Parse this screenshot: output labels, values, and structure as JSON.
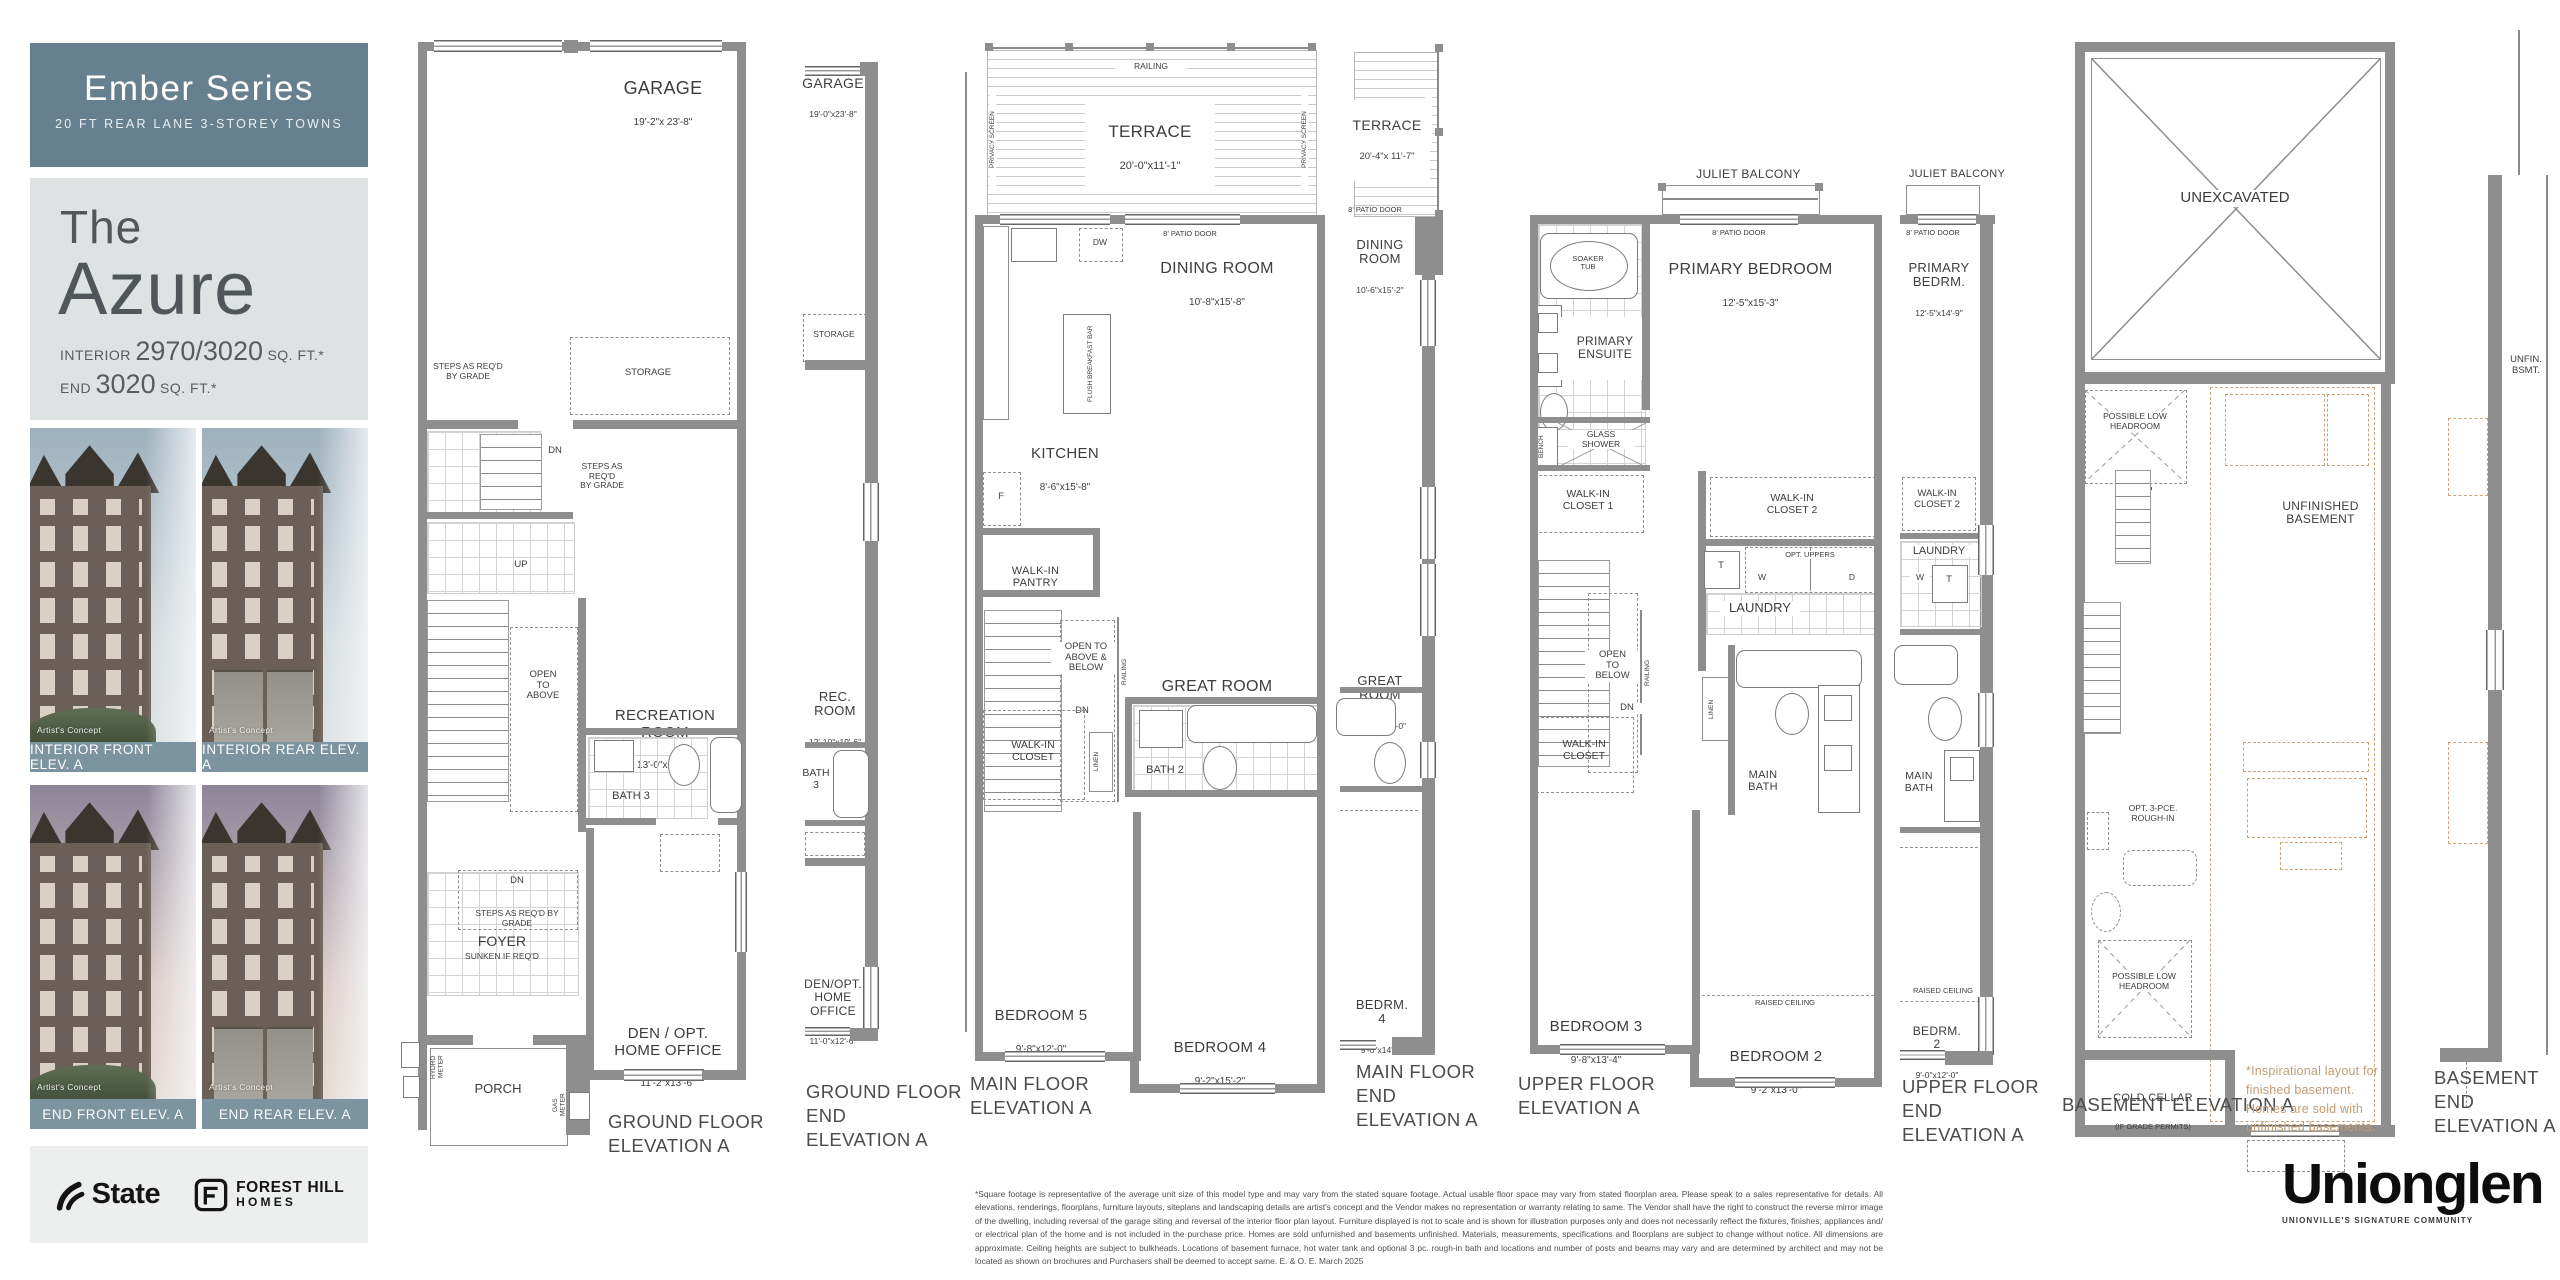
{
  "sidebar": {
    "series": {
      "title": "Ember Series",
      "subtitle": "20 FT REAR LANE 3-STOREY TOWNS"
    },
    "model": {
      "prefix": "The",
      "name": "Azure",
      "interior_label": "INTERIOR",
      "interior_value": "2970/3020",
      "interior_unit": "SQ. FT.*",
      "end_label": "END",
      "end_value": "3020",
      "end_unit": "SQ. FT.*"
    },
    "photos": [
      {
        "caption": "INTERIOR FRONT ELEV. A",
        "credit": "Artist's Concept"
      },
      {
        "caption": "INTERIOR REAR ELEV. A",
        "credit": "Artist's Concept"
      },
      {
        "caption": "END FRONT ELEV. A",
        "credit": "Artist's Concept"
      },
      {
        "caption": "END REAR ELEV. A",
        "credit": "Artist's Concept"
      }
    ],
    "logos": {
      "state": "State",
      "forest_hill": "FOREST HILL",
      "homes": "HOMES"
    }
  },
  "plans": {
    "ground": {
      "caption": "GROUND FLOOR\nELEVATION A",
      "garage": "GARAGE",
      "garage_dims": "19'-2\"x 23'-8\"",
      "storage": "STORAGE",
      "steps_grade": "STEPS AS REQ'D\nBY GRADE",
      "steps_grade_stair": "STEPS AS\nREQ'D\nBY GRADE",
      "steps_grade_foyer": "STEPS AS REQ'D BY GRADE",
      "dn": "DN",
      "up": "UP",
      "open_above": "OPEN\nTO\nABOVE",
      "rec": "RECREATION ROOM",
      "rec_dims": "13'-0\"x19'-6\"",
      "bath3": "BATH 3",
      "foyer": "FOYER",
      "foyer_sub": "SUNKEN IF REQ'D",
      "den": "DEN / OPT.\nHOME OFFICE",
      "den_dims": "11'-2\"x13'-6\"",
      "porch": "PORCH",
      "hydro": "HYDRO\nMETER",
      "gas": "GAS\nMETER"
    },
    "ground_end": {
      "caption": "GROUND FLOOR\nEND\nELEVATION A",
      "garage": "GARAGE",
      "garage_dims": "19'-0\"x23'-8\"",
      "storage": "STORAGE",
      "rec": "REC.\nROOM",
      "rec_dims": "12'-10\"x19'-6\"",
      "bath3": "BATH\n3",
      "den": "DEN/OPT.\nHOME\nOFFICE",
      "den_dims": "11'-0\"x12'-6\""
    },
    "main": {
      "caption": "MAIN FLOOR\nELEVATION A",
      "railing": "RAILING",
      "privacy": "PRIVACY SCREEN",
      "terrace": "TERRACE",
      "terrace_dims": "20'-0\"x11'-1\"",
      "patio": "8' PATIO DOOR",
      "dining": "DINING ROOM",
      "dining_dims": "10'-8\"x15'-8\"",
      "dw": "DW",
      "island": "FLUSH BREAKFAST BAR",
      "kitchen": "KITCHEN",
      "kitchen_dims": "8'-6\"x15'-8\"",
      "fridge": "F",
      "pantry": "WALK-IN\nPANTRY",
      "open": "OPEN TO\nABOVE &\nBELOW",
      "dn": "DN",
      "great": "GREAT ROOM",
      "great_dims": "13'-0\"x15'-0\"",
      "bath2": "BATH 2",
      "wic": "WALK-IN\nCLOSET",
      "linen": "LINEN",
      "bed5": "BEDROOM 5",
      "bed5_dims": "9'-8\"x12'-0\"",
      "bed4": "BEDROOM 4",
      "bed4_dims": "9'-2\"x15'-2\""
    },
    "main_end": {
      "caption": "MAIN FLOOR\nEND\nELEVATION A",
      "railing": "RAILING",
      "terrace": "TERRACE",
      "terrace_dims": "20'-4\"x 11'-7\"",
      "patio": "8' PATIO DOOR",
      "dining": "DINING\nROOM",
      "dining_dims": "10'-6\"x15'-2\"",
      "great": "GREAT\nROOM",
      "great_dims": "12'-10\"x15'-0\"",
      "bed4": "BEDRM.\n4",
      "bed4_dims": "9'-0\"x14'-2\""
    },
    "upper": {
      "caption": "UPPER FLOOR\nELEVATION A",
      "juliet": "JULIET BALCONY",
      "juliet_dims": "10'-0\"x2'-0\"",
      "patio": "8' PATIO DOOR",
      "primary": "PRIMARY BEDROOM",
      "primary_dims": "12'-5\"x15'-3\"",
      "soaker": "SOAKER\nTUB",
      "ensuite": "PRIMARY\nENSUITE",
      "bench": "BENCH",
      "shower": "GLASS\nSHOWER",
      "wic1": "WALK-IN\nCLOSET 1",
      "wic2": "WALK-IN\nCLOSET 2",
      "opt_uppers": "OPT. UPPERS",
      "w": "W",
      "d": "D",
      "t": "T",
      "laundry": "LAUNDRY",
      "open": "OPEN\nTO\nBELOW",
      "railing": "RAILING",
      "dn": "DN",
      "linen": "LINEN",
      "wic": "WALK-IN\nCLOSET",
      "main_bath": "MAIN\nBATH",
      "bed3": "BEDROOM 3",
      "bed3_dims": "9'-8\"x13'-4\"",
      "raised": "RAISED CEILING",
      "bed2": "BEDROOM 2",
      "bed2_dims": "9'-2\"x13'-0\""
    },
    "upper_end": {
      "caption": "UPPER FLOOR\nEND\nELEVATION A",
      "juliet": "JULIET BALCONY",
      "juliet_dims": "10'-0\"x2'-0\"",
      "patio": "8' PATIO DOOR",
      "primary": "PRIMARY\nBEDRM.",
      "primary_dims": "12'-5\"x14'-9\"",
      "wic2": "WALK-IN\nCLOSET 2",
      "laundry": "LAUNDRY",
      "w": "W",
      "t": "T",
      "main_bath": "MAIN\nBATH",
      "raised": "RAISED CEILING",
      "bed2": "BEDRM.\n2",
      "bed2_dims": "9'-0\"x12'-0\""
    },
    "basement": {
      "caption": "BASEMENT ELEVATION A",
      "unex": "UNEXCAVATED",
      "plh": "POSSIBLE LOW\nHEADROOM",
      "up": "UP",
      "unfinished": "UNFINISHED\nBASEMENT",
      "rough": "OPT. 3-PCE.\nROUGH-IN",
      "plh2": "POSSIBLE LOW\nHEADROOM",
      "cold": "COLD CELLAR",
      "cold_sub": "(IF GRADE PERMITS)",
      "note": "*Inspirational layout for\nfinished basement.\nHomes are sold with\nunfinished basements."
    },
    "basement_end": {
      "caption": "BASEMENT\nEND\nELEVATION A",
      "unfin": "UNFIN.\nBSMT."
    }
  },
  "footer": {
    "disclaimer": "*Square footage is representative of the average unit size of this model type and may vary from the stated square footage. Actual usable floor space may vary from stated floorplan area. Please speak to a sales representative for details. All elevations, renderings, floorplans, furniture layouts, siteplans and landscaping details are artist's concept and the Vendor makes no representation or warranty relating to same. The Vendor shall have the right to construct the reverse mirror image of the dwelling, including reversal of the garage siting and reversal of the interior floor plan layout. Furniture displayed is not to scale and is shown for illustration purposes only and does not necessarily reflect the fixtures, finishes, appliances and/ or electrical plan of the home and is not included in the purchase price. Homes are sold unfurnished and basements unfinished. Materials, measurements, specifications and floorplans are subject to change without notice. All dimensions are approximate. Ceiling heights are subject to bulkheads. Locations of basement furnace, hot water tank and optional 3 pc. rough-in bath and locations and number of posts and beams may vary and are determined by architect and may not be located as shown on brochures and Purchasers shall be deemed to accept same. E. & O. E. March 2025",
    "brand": "Unionglen",
    "tagline": "UNIONVILLE'S SIGNATURE COMMUNITY"
  },
  "colors": {
    "slate": "#66808F",
    "panel": "#DFE2E3",
    "wall": "#8E8E8E",
    "tan_dash": "#CAA47C",
    "note_text": "#C49B72",
    "caption_bar": "#7C93A0"
  }
}
